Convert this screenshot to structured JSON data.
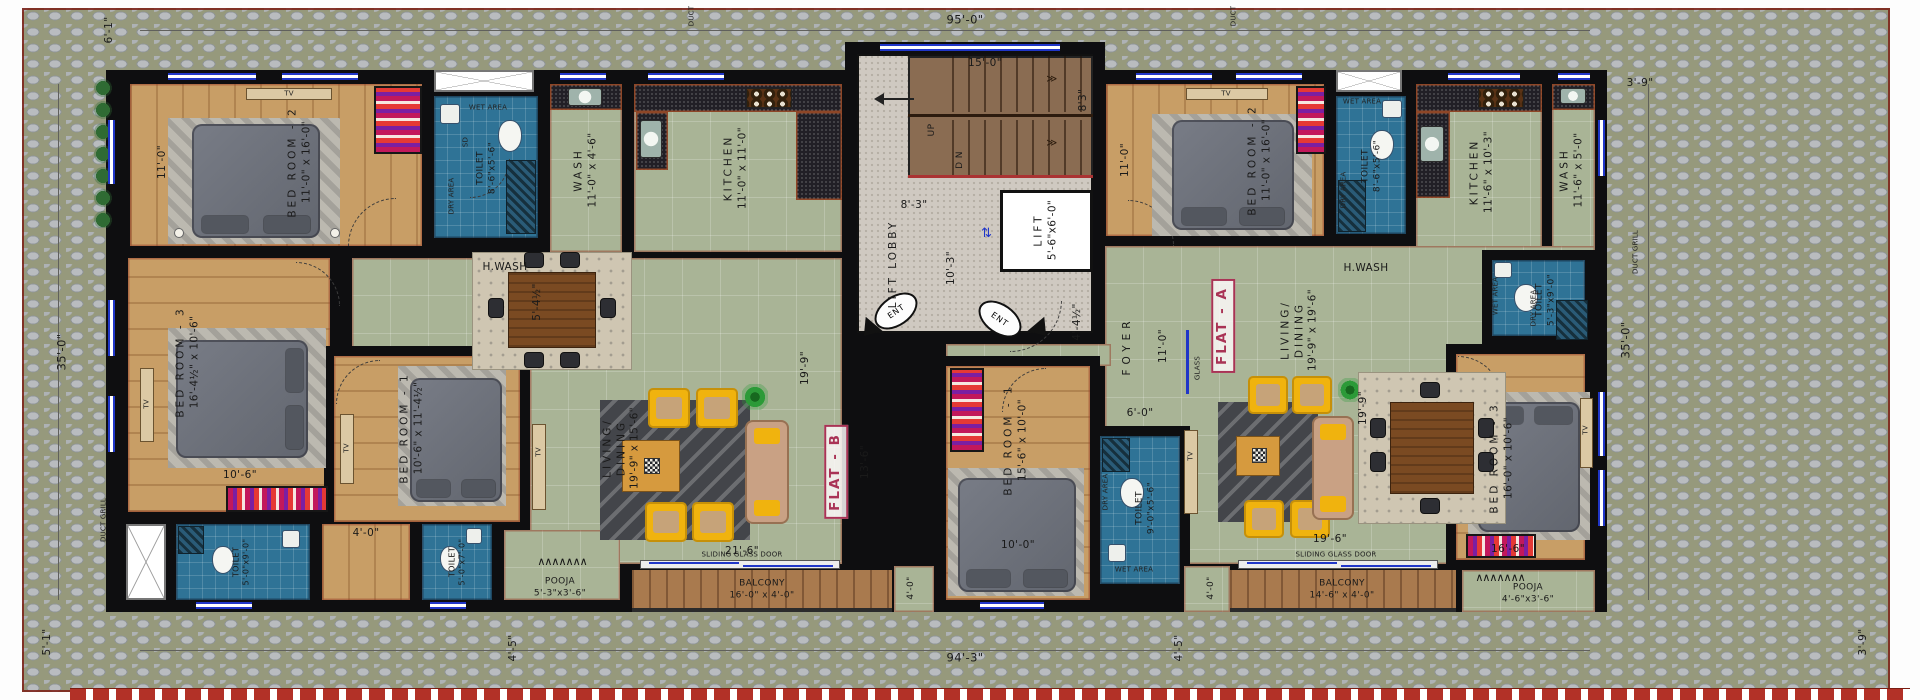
{
  "flat_b": {
    "label": "FLAT - B",
    "bedroom2": {
      "name": "BED ROOM - 2",
      "dims": "11'-0\" x 16'-0\"",
      "width_dim": "11'-0\""
    },
    "toilet": {
      "name": "TOILET",
      "dims": "8'-6\"x5'-6\""
    },
    "wash": {
      "name": "WASH",
      "dims": "11'-0\" x 4'-6\""
    },
    "kitchen": {
      "name": "KITCHEN",
      "dims": "11'-0\" x 11'-0\""
    },
    "living": {
      "name1": "LIVING/",
      "name2": "DINING",
      "dims": "19'-9\" x 15'-6\"",
      "dim_l": "19'-9\"",
      "dim_13": "13'-6\"",
      "dim_21": "21'-6\""
    },
    "bedroom3": {
      "name": "BED ROOM - 3",
      "dims": "16'-4½\" x 10'-6\"",
      "width_dim": "10'-6\""
    },
    "bedroom1": {
      "name": "BED ROOM - 1",
      "dims": "10'-6\" x 11'-4½\""
    },
    "toilet_master": {
      "name": "TOILET",
      "dims": "5'-0\"x9'-0\""
    },
    "toilet_common": {
      "name": "TOILET",
      "dims": "5'-0\"x7'-0\""
    },
    "pooja": {
      "name": "POOJA",
      "dims": "5'-3\"x3'-6\""
    },
    "balcony": {
      "name": "BALCONY",
      "dims": "16'-0\" x 4'-0\"",
      "depth_dim": "4'-0\""
    },
    "dim_hall": "5'-4½\"",
    "dim_passage": "4'-0\""
  },
  "flat_a": {
    "label": "FLAT - A",
    "bedroom2": {
      "name": "BED ROOM - 2",
      "dims": "11'-0\" x 16'-0\"",
      "width_dim": "11'-0\""
    },
    "toilet": {
      "name": "TOILET",
      "dims": "8'-6\"x5'-6\""
    },
    "kitchen": {
      "name": "KITCHEN",
      "dims": "11'-6\" x 10'-3\""
    },
    "wash": {
      "name": "WASH",
      "dims": "11'-6\" x 5'-0\""
    },
    "foyer": {
      "name": "FOYER",
      "dim": "11'-0\"",
      "dim2": "4'-4½\"",
      "dim3": "6'-0\"",
      "glass": "GLASS"
    },
    "living": {
      "name1": "LIVING/",
      "name2": "DINING",
      "dims": "19'-9\" x 19'-6\"",
      "dim_l": "19'-9\"",
      "dim_w": "19'-6\""
    },
    "bedroom1": {
      "name": "BED ROOM - 1",
      "dims": "15'-6\" x 10'-0\"",
      "width_dim": "10'-0\""
    },
    "toilet_master": {
      "name": "TOILET",
      "dims": "9'-0\"x5'-6\""
    },
    "toilet_common": {
      "name": "TOILET",
      "dims": "5'-3\"x9'-0\""
    },
    "bedroom3": {
      "name": "BED ROOM - 3",
      "dims": "16'-0\" x 10'-6\"",
      "width_dim": "16'-6\""
    },
    "pooja": {
      "name": "POOJA",
      "dims": "4'-6\"x3'-6\""
    },
    "balcony": {
      "name": "BALCONY",
      "dims": "14'-6\" x 4'-0\"",
      "depth_dim": "4'-0\""
    }
  },
  "core": {
    "stair_width": "15'-0\"",
    "stair_depth": "8'3\"",
    "up": "UP",
    "down": "D N",
    "lobby_width": "8'-3\"",
    "lift_lobby": "LIFT LOBBY",
    "lobby_length": "10'-3\"",
    "lift": "LIFT",
    "lift_dims": "5'-6\"x6'-0\"",
    "ent": "ENT"
  },
  "boundary": {
    "top": "95'-0\"",
    "bottom": "94'-3\"",
    "left": "35'-0\"",
    "right": "35'-0\"",
    "top_left": "6'-1\"",
    "top_right": "3'-9\"",
    "bottom_left": "5'-1\"",
    "bottom_right": "3'-9\"",
    "offset_left": "4'-5\"",
    "offset_right": "4'-5\"",
    "duct": "DUCT",
    "duct_grill": "DUCT GRILL"
  },
  "annotations": {
    "hwash": "H.WASH",
    "wet_area": "WET AREA",
    "dry_area": "DRY AREA",
    "sd": "SD",
    "tv": "TV",
    "sliding_door": "SLIDING GLASS DOOR"
  },
  "symbols": {
    "stair_direction": "≫",
    "lift_door": "⇄",
    "pooja_shelf": "∧∧∧∧∧∧∧"
  }
}
